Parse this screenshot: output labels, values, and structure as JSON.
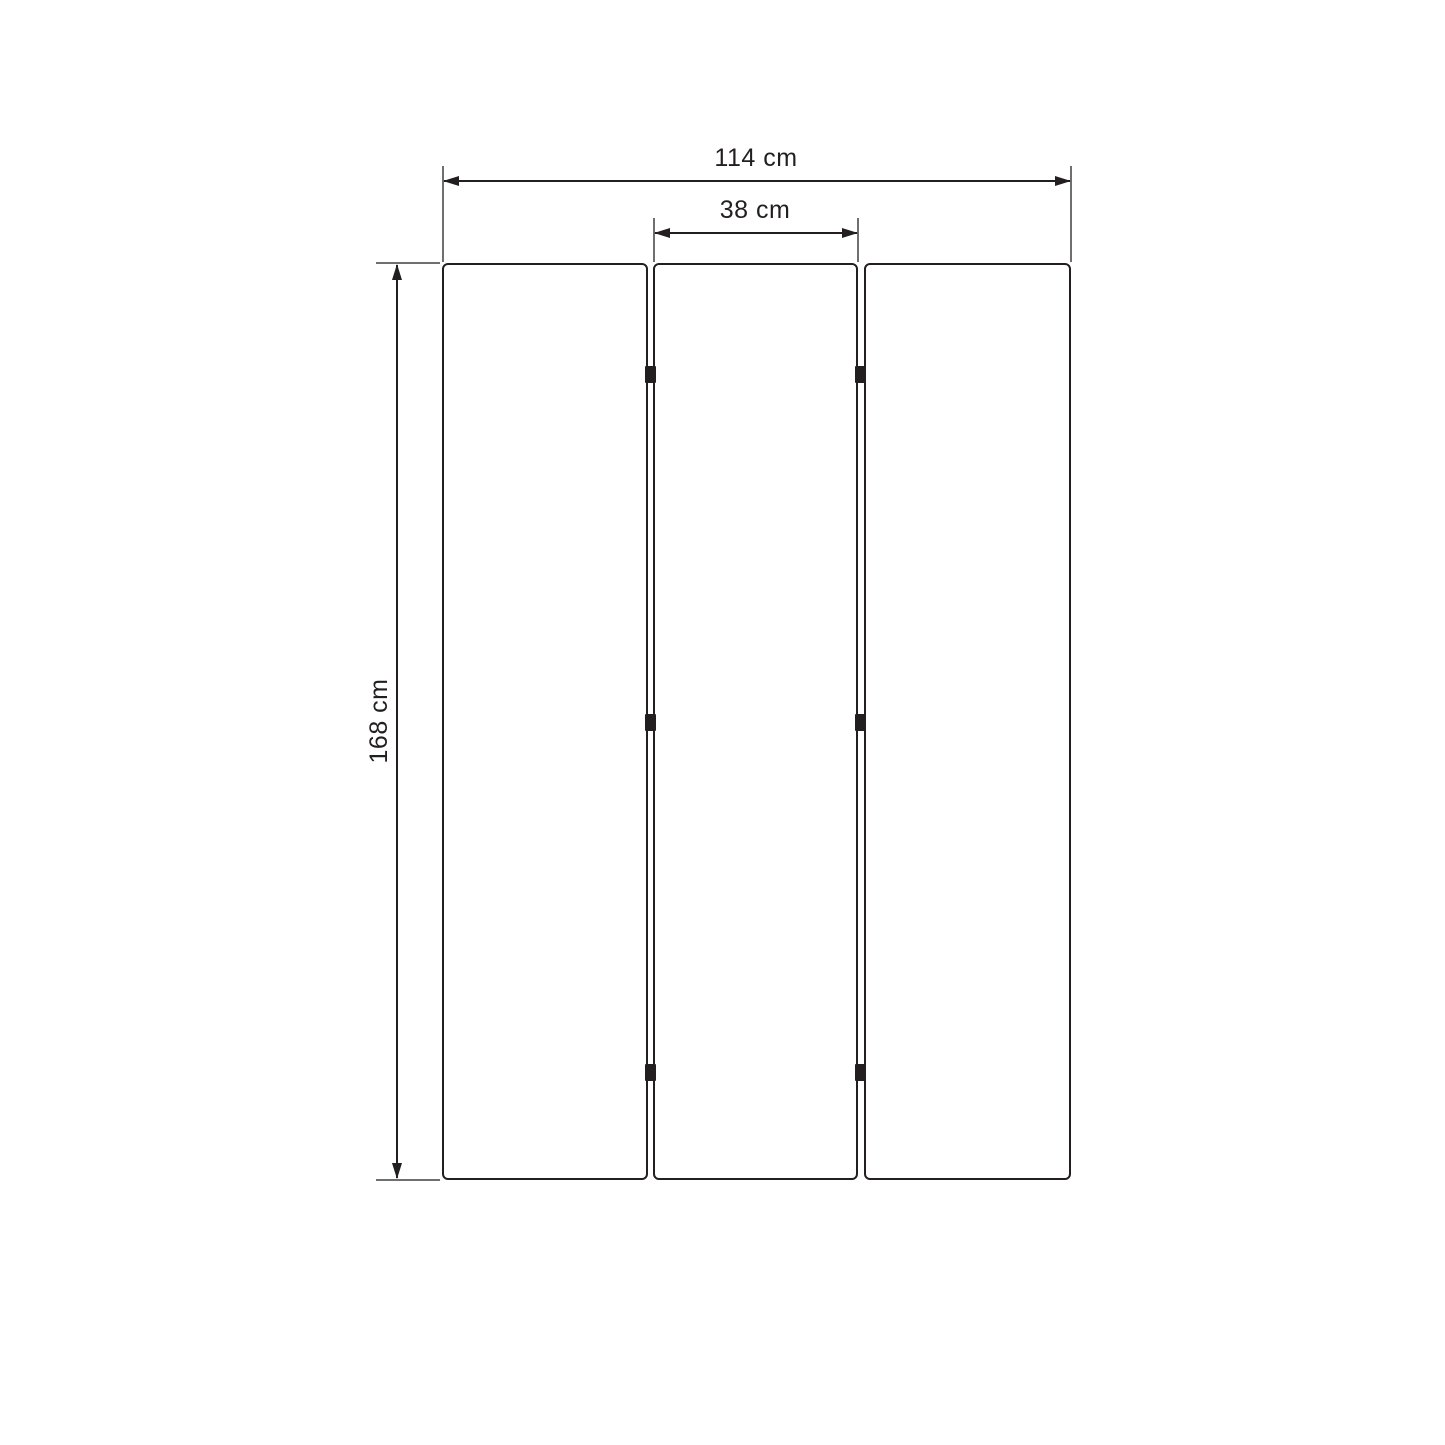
{
  "diagram": {
    "panel_count": 3,
    "hinge_count": 6,
    "labels": {
      "total_width": "114 cm",
      "panel_width": "38 cm",
      "height": "168 cm"
    },
    "colors": {
      "line": "#231f20",
      "extension_line": "#6f6f6f",
      "background": "#ffffff"
    }
  }
}
